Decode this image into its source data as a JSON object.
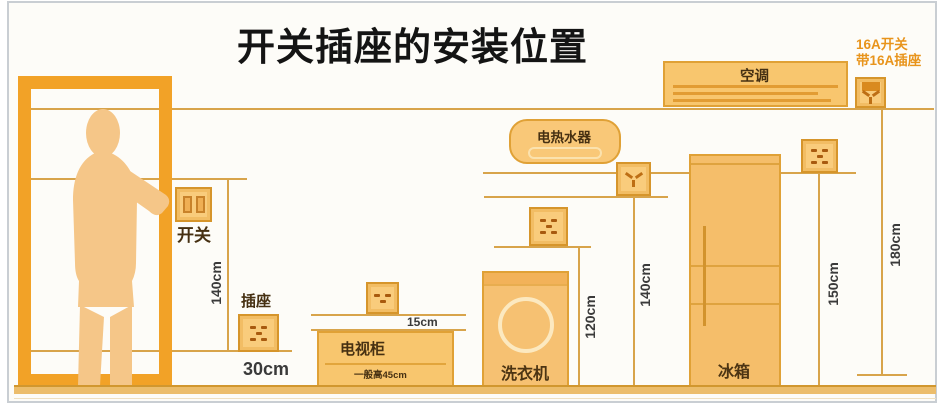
{
  "title": "开关插座的安装位置",
  "door_area": {
    "switch_label": "开关",
    "switch_height": "140cm",
    "socket_label": "插座",
    "socket_height": "30cm"
  },
  "tv": {
    "label": "电视柜",
    "note": "一般高45cm",
    "socket_gap": "15cm"
  },
  "washer": {
    "label": "洗衣机",
    "socket_height": "120cm"
  },
  "heater": {
    "label": "电热水器",
    "socket_height": "140cm"
  },
  "fridge": {
    "label": "冰箱",
    "socket_height": "150cm"
  },
  "ac": {
    "label": "空调",
    "note_line1": "16A开关",
    "note_line2": "带16A插座",
    "socket_height": "180cm"
  },
  "colors": {
    "door_orange": "#F2A227",
    "person_tan": "#F5C688",
    "appliance_fill": "#F8C66E",
    "appliance_border": "#E0A136",
    "guide_line": "#D8A44B",
    "note_orange": "#E8941C",
    "text_dark": "#3A3A3A"
  }
}
